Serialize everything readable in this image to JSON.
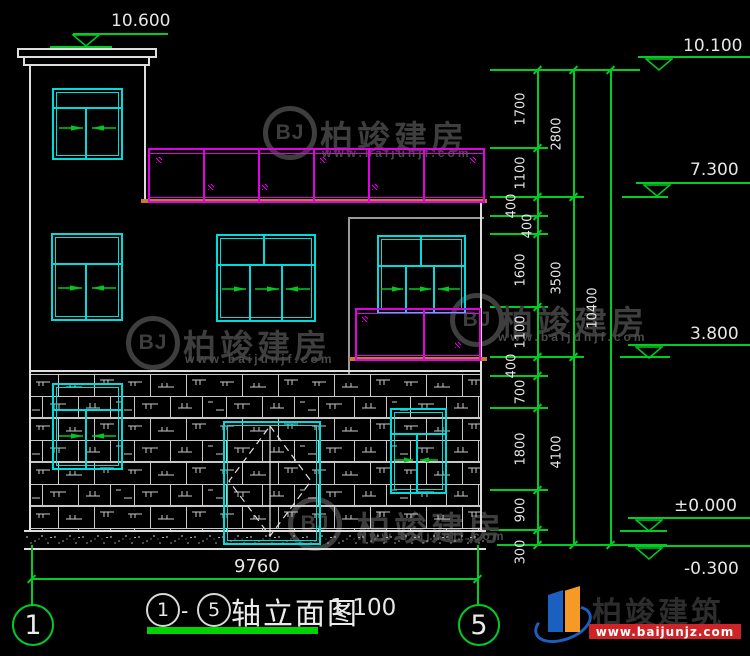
{
  "watermark": {
    "logo": "BJ",
    "name": "柏竣建房",
    "url": "www.baijunjf.com"
  },
  "brand": {
    "name": "柏竣建筑",
    "url": "www.baijunjz.com"
  },
  "title": {
    "axis_start": "1",
    "separator": "-",
    "axis_end": "5",
    "name": "轴立面图",
    "scale": "1:100"
  },
  "axes": {
    "left": "1",
    "right": "5"
  },
  "levels": {
    "tower_top": "10.600",
    "right": [
      "10.100",
      "7.300",
      "3.800",
      "±0.000",
      "-0.300"
    ]
  },
  "dims": {
    "col1": [
      "1700",
      "1100",
      "400",
      "400",
      "1600",
      "1100",
      "400",
      "700",
      "1800",
      "900",
      "300"
    ],
    "col2": [
      "2800",
      "3500",
      "4100"
    ],
    "col3": [
      "10400"
    ],
    "width": "9760"
  },
  "colors": {
    "dimension_green": "#00cc22",
    "window_cyan": "#00dcdc",
    "railing_magenta": "#e400e4",
    "slab_orange": "#c87a33",
    "outline_white": "#dedede",
    "background": "#000000"
  }
}
